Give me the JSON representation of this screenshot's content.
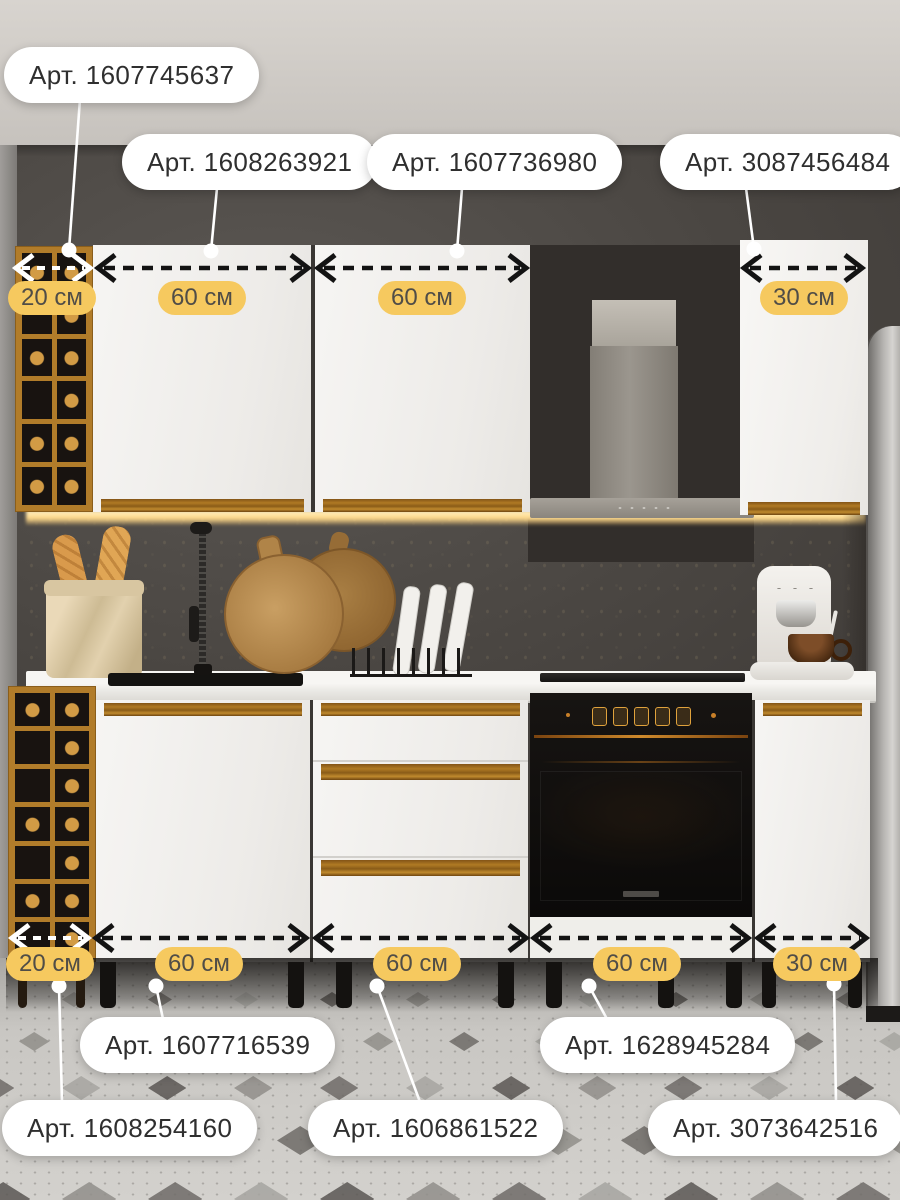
{
  "image": {
    "type": "kitchen furniture set product photo with article-number callouts and width dimensions",
    "language": "ru",
    "unit": "см"
  },
  "palette": {
    "accent_badge": "#f6c95f",
    "pill_background": "#ffffff",
    "pill_text": "#2f2f2f",
    "badge_text": "#504d47",
    "arrow_dark": "#131313",
    "arrow_light": "#ffffff"
  },
  "top_callouts": [
    {
      "label": "Арт. 1607745637"
    },
    {
      "label": "Арт. 1608263921"
    },
    {
      "label": "Арт. 1607736980"
    },
    {
      "label": "Арт. 3087456484"
    }
  ],
  "top_dimensions": [
    {
      "label": "20 см"
    },
    {
      "label": "60 см"
    },
    {
      "label": "60 см"
    },
    {
      "label": "30 см"
    }
  ],
  "bottom_dimensions": [
    {
      "label": "20 см"
    },
    {
      "label": "60 см"
    },
    {
      "label": "60 см"
    },
    {
      "label": "60 см"
    },
    {
      "label": "30 см"
    }
  ],
  "bottom_callouts": [
    {
      "label": "Арт. 1607716539"
    },
    {
      "label": "Арт. 1628945284"
    },
    {
      "label": "Арт. 1608254160"
    },
    {
      "label": "Арт. 1606861522"
    },
    {
      "label": "Арт. 3073642516"
    }
  ]
}
